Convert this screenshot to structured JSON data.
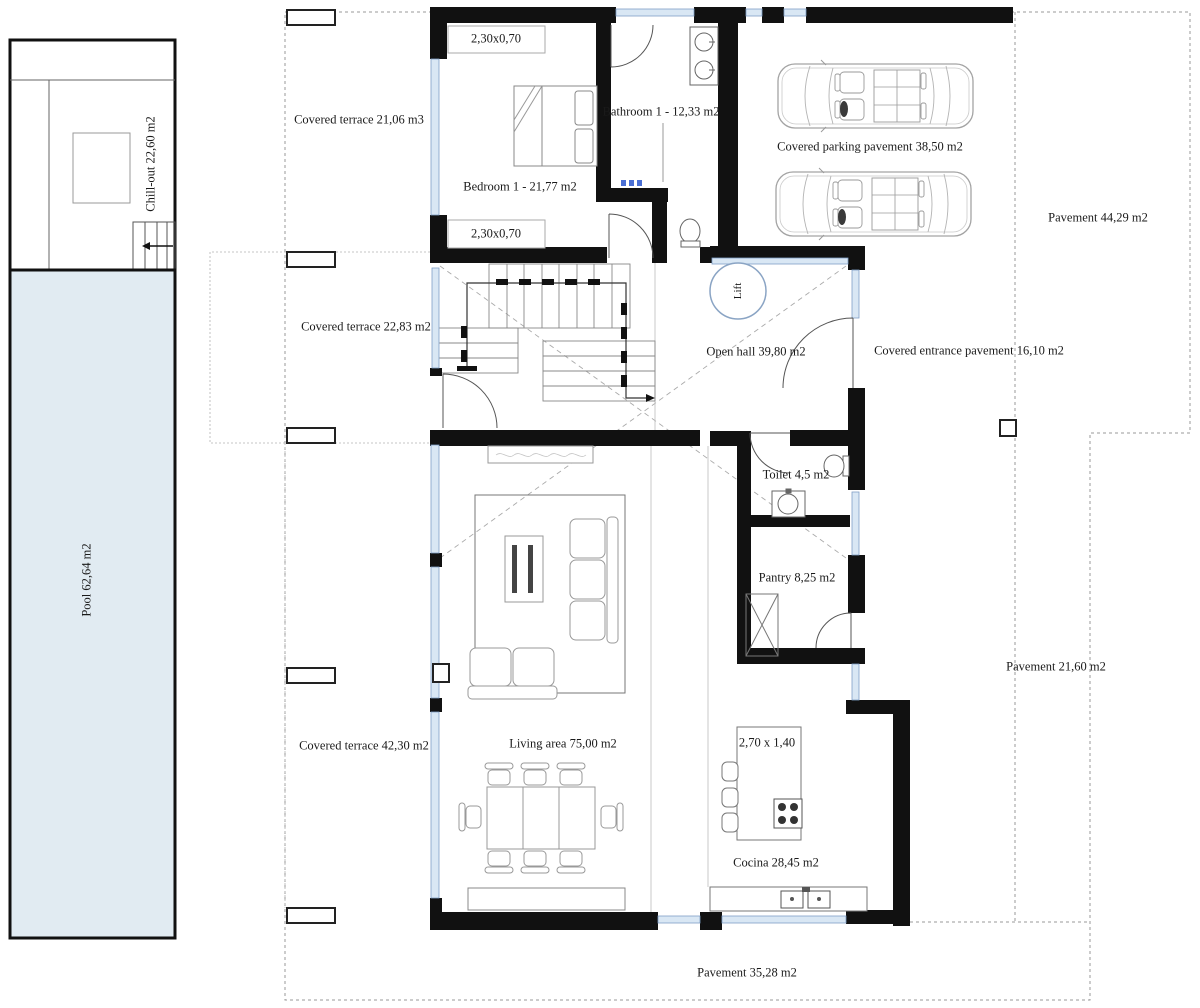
{
  "type": "floor-plan",
  "labels": {
    "chill_out": "Chill-out 22,60 m2",
    "pool": "Pool 62,64 m2",
    "terrace_top": "Covered terrace 21,06 m3",
    "wardrobe_top": "2,30x0,70",
    "bedroom1": "Bedroom 1 - 21,77 m2",
    "wardrobe_bottom": "2,30x0,70",
    "bathroom1": "Bathroom 1 - 12,33 m2",
    "parking": "Covered parking pavement 38,50 m2",
    "pavement_right": "Pavement 44,29 m2",
    "terrace_mid": "Covered terrace 22,83 m2",
    "open_hall": "Open hall 39,80 m2",
    "entrance": "Covered entrance pavement 16,10 m2",
    "lift": "Lift",
    "toilet": "Toilet 4,5 m2",
    "pantry": "Pantry 8,25 m2",
    "terrace_bottom": "Covered terrace 42,30 m2",
    "living": "Living area 75,00 m2",
    "pavement_se": "Pavement 21,60 m2",
    "island": "2,70 x 1,40",
    "kitchen": "Cocina 28,45 m2",
    "pavement_bottom": "Pavement 35,28 m2"
  },
  "colors": {
    "wall": "#111111",
    "pool_fill": "#e1ebf2",
    "window_glass": "#d9e7f4",
    "window_frame": "#7f9fc6",
    "site_boundary": "#999999",
    "lift_ring": "#8aa4c4",
    "accent_blue": "#4a6fd4"
  }
}
